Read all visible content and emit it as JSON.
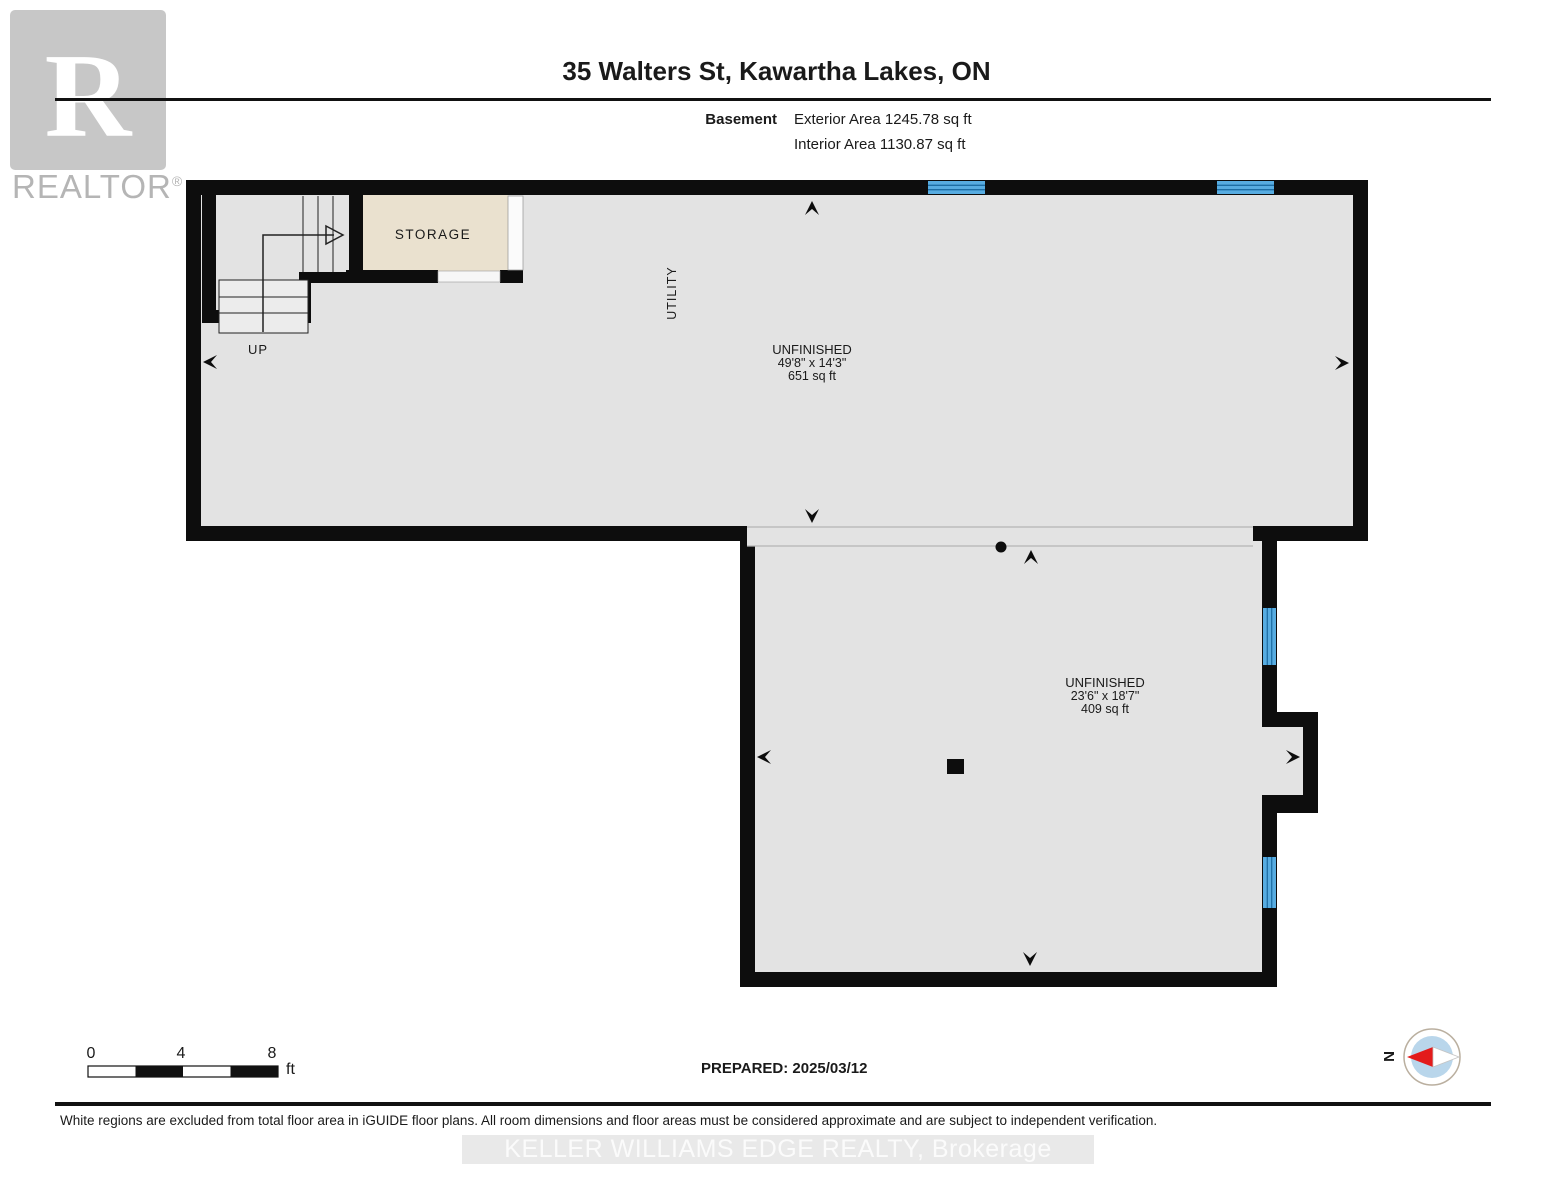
{
  "logo": {
    "letter": "R",
    "brand": "REALTOR",
    "registered": "®"
  },
  "header": {
    "title": "35 Walters St, Kawartha Lakes, ON",
    "floor_label": "Basement",
    "exterior_area": "Exterior Area 1245.78 sq ft",
    "interior_area": "Interior Area 1130.87 sq ft"
  },
  "plan": {
    "storage_label": "STORAGE",
    "utility_label": "UTILITY",
    "up_label": "UP",
    "room_upper": {
      "name": "UNFINISHED",
      "dims": "49'8\" x 14'3\"",
      "area": "651 sq ft"
    },
    "room_lower": {
      "name": "UNFINISHED",
      "dims": "23'6\" x 18'7\"",
      "area": "409 sq ft"
    }
  },
  "scale_bar": {
    "t0": "0",
    "t4": "4",
    "t8": "8",
    "unit": "ft"
  },
  "prepared_label": "PREPARED: 2025/03/12",
  "compass": {
    "north": "N"
  },
  "footer": {
    "disclaimer": "White regions are excluded from total floor area in iGUIDE floor plans. All room dimensions and floor areas must be considered approximate and are subject to independent verification.",
    "watermark": "KELLER WILLIAMS EDGE REALTY, Brokerage"
  },
  "colors": {
    "wall": "#0d0d0d",
    "floor": "#e3e3e3",
    "storage": "#eae1cf",
    "window_fill": "#57ace1",
    "window_stroke": "#1d6ea5",
    "compass_inner": "#b9d6eb",
    "needle_red": "#e31b1b"
  }
}
